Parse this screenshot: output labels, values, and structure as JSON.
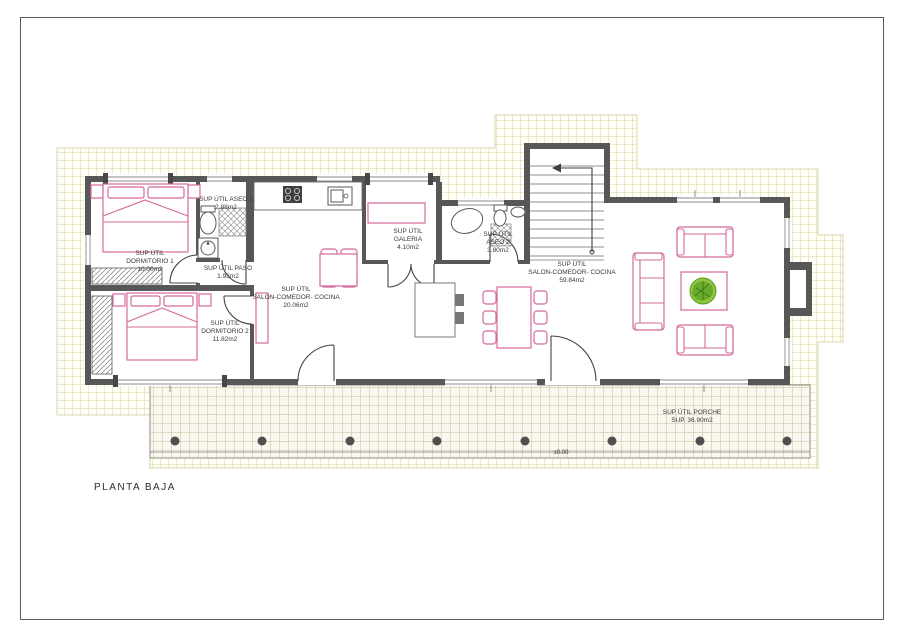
{
  "page": {
    "title": "PLANTA BAJA",
    "level_mark": "±0.00",
    "drawing_type": "floor-plan"
  },
  "colors": {
    "wall": "#575757",
    "furniture_pink": "#d4699b",
    "site_grid": "#d9d19e",
    "plant_green": "#8cc63f"
  },
  "labels": {
    "dorm1": [
      "SUP ÚTIL",
      "DORMITORIO 1",
      "10.00m2"
    ],
    "aseo1": [
      "SUP ÚTIL ASEO 1",
      "2.88m2"
    ],
    "paso": [
      "SUP ÚTIL PASO",
      "1.93m2"
    ],
    "galeria": [
      "SUP ÚTIL",
      "GALERIA",
      "4.10m2"
    ],
    "aseo2": [
      "SUP ÚTIL",
      "ASEO 2",
      "3.80m2"
    ],
    "salon1": [
      "SUP ÚTIL",
      "SALON-COMEDOR- COCINA",
      "20.06m2"
    ],
    "salon2": [
      "SUP ÚTIL",
      "SALON-COMEDOR- COCINA",
      "59.84m2"
    ],
    "dorm2": [
      "SUP ÚTIL",
      "DORMITORIO 2",
      "11.82m2"
    ],
    "porche": [
      "SUP ÚTIL PORCHE",
      "SUP. 36.90m2"
    ]
  }
}
